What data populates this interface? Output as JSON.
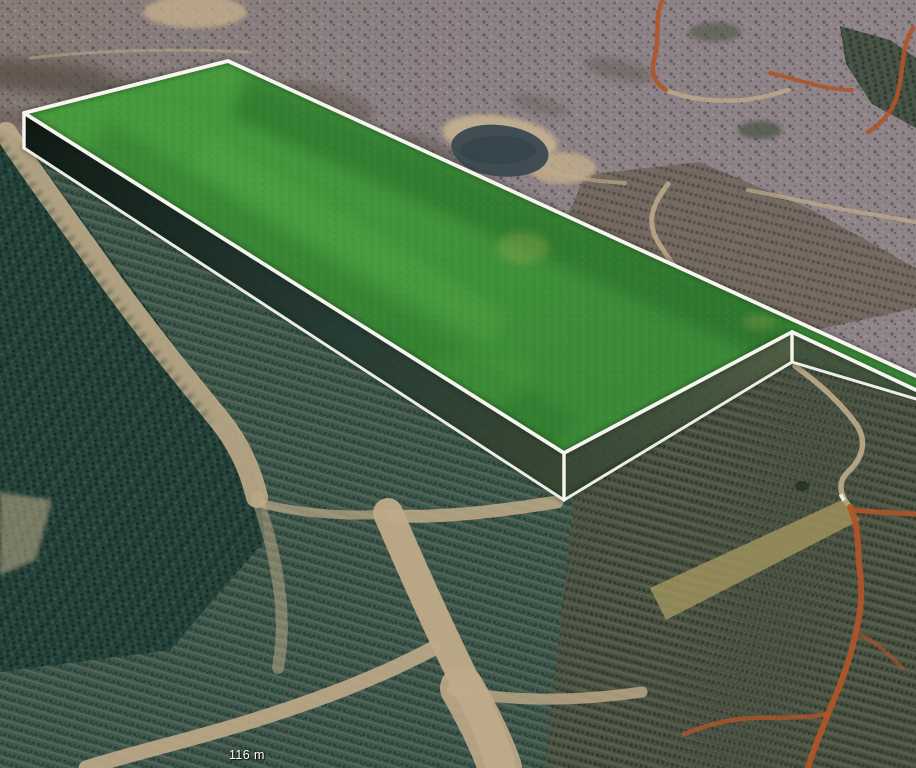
{
  "hud": {
    "elevation_label": "116 m"
  },
  "overlay": {
    "name": "highlighted land parcel (3D extruded boundary)",
    "fill_color": "#3f9439",
    "outline_color": "#f6f5ef",
    "wall_color": "#31492c"
  },
  "terrain": {
    "clearcut_color": "#8b8084",
    "scrub_color": "#6e6159",
    "sand_color": "#c3ae8c",
    "water_color": "#3c4a52",
    "vegetation_color": "#41584d",
    "forest_color": "#27433b",
    "plantation_brown_color": "#56503d",
    "dirt_road_color": "#bfab89",
    "clay_road_color": "#b05429"
  }
}
